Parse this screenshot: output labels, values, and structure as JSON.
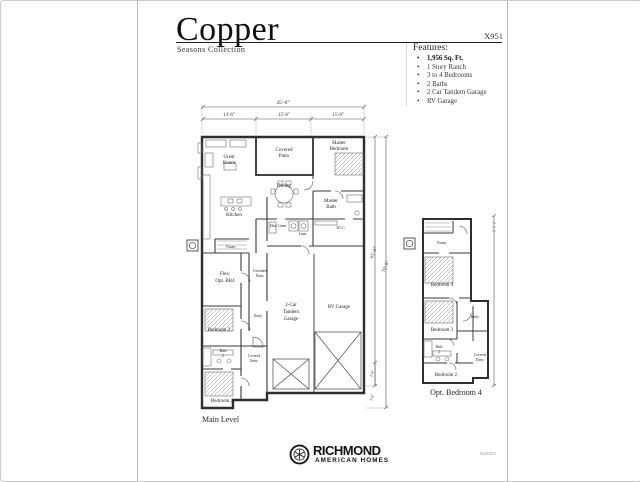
{
  "document": {
    "title": "Copper",
    "collection": "Seasons Collection",
    "plan_code": "X951",
    "print_date": "04/2022"
  },
  "features": {
    "heading": "Features:",
    "items": [
      "1,956 Sq. Ft.",
      "1 Story Ranch",
      "3 to 4 Bedrooms",
      "2 Baths",
      "2 Car Tandem Garage",
      "RV Garage"
    ]
  },
  "main_plan": {
    "caption": "Main Level",
    "dimensions": {
      "overall_width": "45'-0\"",
      "width_segments": [
        "14'-6\"",
        "15'-6\"",
        "15'-0\""
      ],
      "depth_inner": "65'-0\"",
      "depth_outer": "70'-0\"",
      "small_dims": [
        "2'-0\"",
        "3'-0\""
      ]
    },
    "rooms": {
      "great_room": [
        "Great",
        "Room"
      ],
      "covered_patio": [
        "Covered",
        "Patio"
      ],
      "master_bedroom": [
        "Master",
        "Bedroom"
      ],
      "dining": "Dining",
      "kitchen": "Kitchen",
      "master_bath": [
        "Master",
        "Bath"
      ],
      "wic": "W.i.C.",
      "mud": "Mud",
      "linen": "Linen",
      "laundry": "Laun.",
      "pantry": "Pantry",
      "flex": [
        "Flex/",
        "Opt. BR4"
      ],
      "extended_entry": [
        "Extended",
        "Entry"
      ],
      "entry": "Entry",
      "bedroom_3": "Bedroom 3",
      "bath_2": [
        "Bath",
        "2"
      ],
      "bedroom_2": "Bedroom 2",
      "covered_entry": [
        "Covered",
        "Entry"
      ],
      "tandem_garage": [
        "2-Car",
        "Tandem",
        "Garage"
      ],
      "rv_garage": "RV Garage"
    }
  },
  "opt_plan": {
    "caption": "Opt. Bedroom 4",
    "rooms": {
      "pantry": "Pantry",
      "bedroom_4": "Bedroom 4",
      "bedroom_3": "Bedroom 3",
      "entry": "Entry",
      "bath_2": [
        "Bath",
        "2"
      ],
      "covered_entry": [
        "Covered",
        "Entry"
      ],
      "bedroom_2": "Bedroom 2"
    }
  },
  "brand": {
    "name": "RICHMOND",
    "subtitle": "AMERICAN HOMES"
  }
}
